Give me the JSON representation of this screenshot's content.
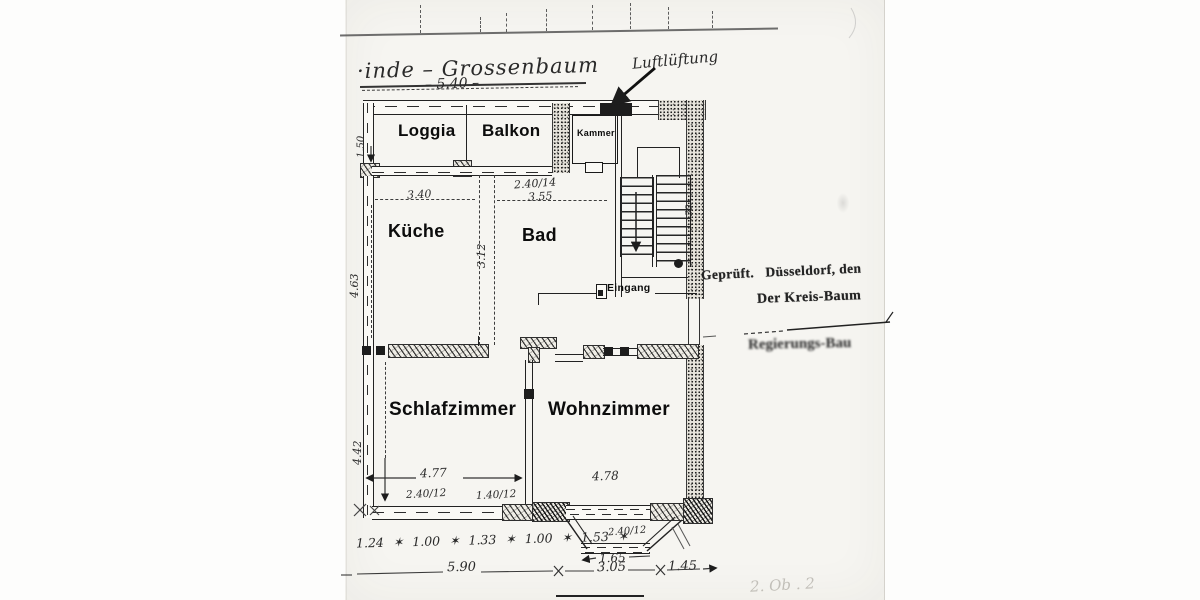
{
  "palette": {
    "paper": "#fdfdfc",
    "scan": "#f6f5f1",
    "ink": "#1c1c1c",
    "hatch_ink": "#2e2e2e",
    "faint": "#9a968e"
  },
  "header": {
    "handwritten_title": "·inde – Grossenbaum",
    "title_dim": "– 5.40 –",
    "vent_note": "Luftlüftung"
  },
  "rooms": {
    "loggia": {
      "label": "Loggia"
    },
    "balkon": {
      "label": "Balkon"
    },
    "kammer": {
      "label": "Kammer"
    },
    "kueche": {
      "label": "Küche"
    },
    "bad": {
      "label": "Bad"
    },
    "eingang": {
      "label": "Eingang"
    },
    "schlafzimmer": {
      "label": "Schlafzimmer"
    },
    "wohnzimmer": {
      "label": "Wohnzimmer"
    }
  },
  "stamp": {
    "line1": "Geprüft.   Düsseldorf, den",
    "line2": "Der Kreis-Baum",
    "line3": "Regierungs-Bau"
  },
  "dims": {
    "loggia_depth": "1.50",
    "kueche_width": "3.40",
    "kueche_height": "4.63",
    "bad_top": "2.40/14",
    "bad_width": "3.55",
    "bad_height": "3.12",
    "wall_note": "30",
    "schlaf_height": "4.42",
    "schlaf_width": "4.77",
    "window_a": "2.40/12",
    "window_b": "1.40/12",
    "wohn_width": "4.78",
    "bay_window": "2.40/12",
    "bay_width": "1.65",
    "bottom_row": "1.24 ✶ 1.00 ✶ 1.33 ✶ 1.00 ✶ 1.53 ✶",
    "total_width": "5.90",
    "bay_total": "3.05",
    "side_offset": "1.45",
    "corner_note": "2. Ob . 2"
  }
}
